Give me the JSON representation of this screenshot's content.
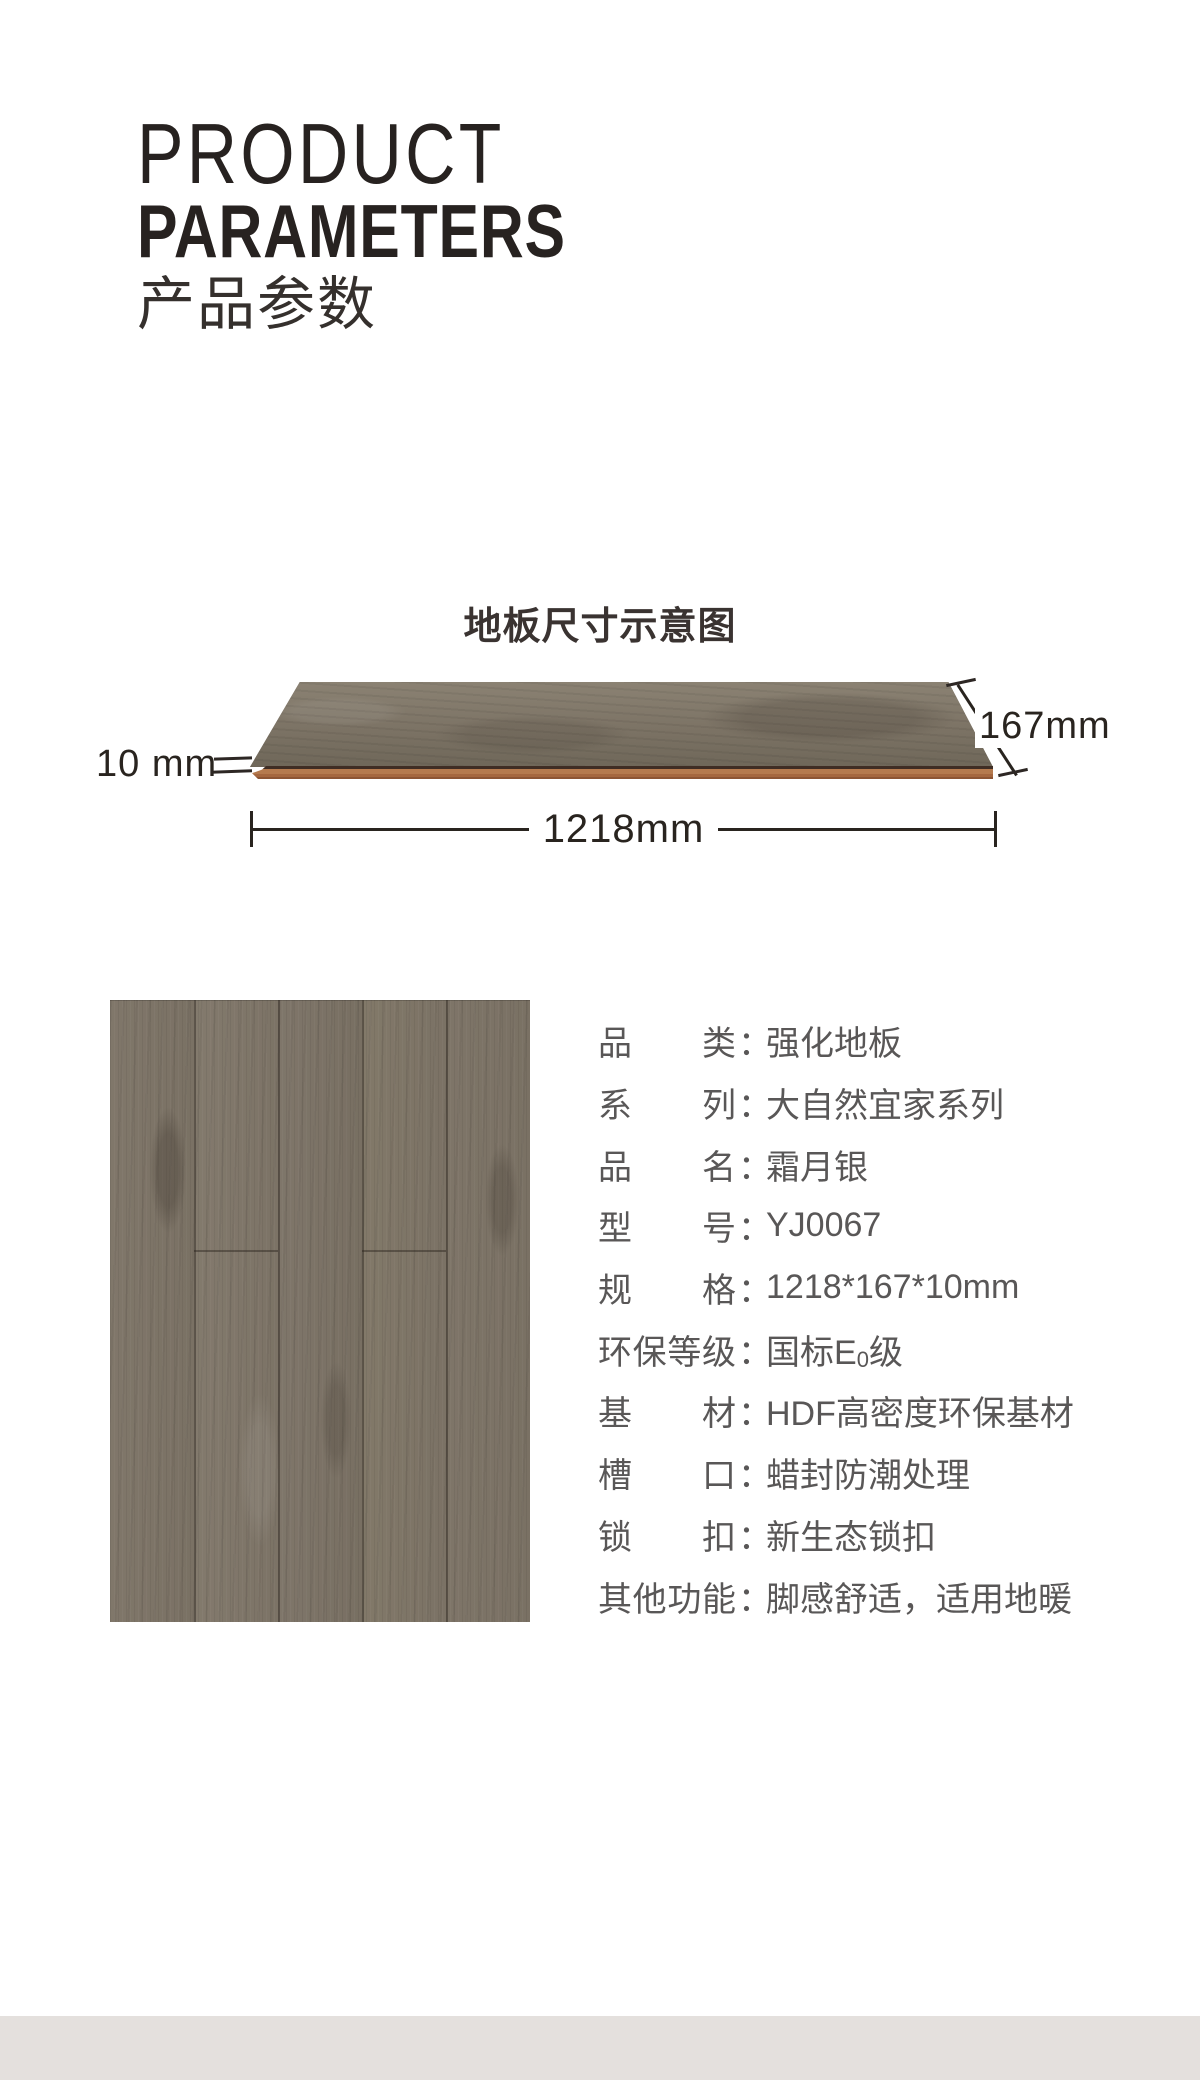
{
  "header": {
    "title_line1": "PRODUCT",
    "title_line2": "PARAMETERS",
    "title_cn": "产品参数"
  },
  "diagram": {
    "heading": "地板尺寸示意图",
    "thickness_label": "10 mm",
    "width_label": "167mm",
    "length_label": "1218mm"
  },
  "specs": {
    "colon": "：",
    "rows": [
      {
        "label": "品类",
        "value": "强化地板"
      },
      {
        "label": "系列",
        "value": "大自然宜家系列"
      },
      {
        "label": "品名",
        "value": "霜月银"
      },
      {
        "label": "型号",
        "value": "YJ0067"
      },
      {
        "label": "规格",
        "value": "1218*167*10mm"
      },
      {
        "label": "环保等级",
        "value_prefix": "国标E",
        "value_sub": "0",
        "value_suffix": "级"
      },
      {
        "label": "基材",
        "value": "HDF高密度环保基材"
      },
      {
        "label": "槽口",
        "value": "蜡封防潮处理"
      },
      {
        "label": "锁扣",
        "value": "新生态锁扣"
      },
      {
        "label": "其他功能",
        "value": "脚感舒适，适用地暖"
      }
    ]
  },
  "colors": {
    "accent_dark": "#272220",
    "text_gray": "#595757",
    "wood_base": "#7b7265",
    "wood_edge_strip": "#b5784b",
    "footer_band": "#e4e0dd"
  }
}
